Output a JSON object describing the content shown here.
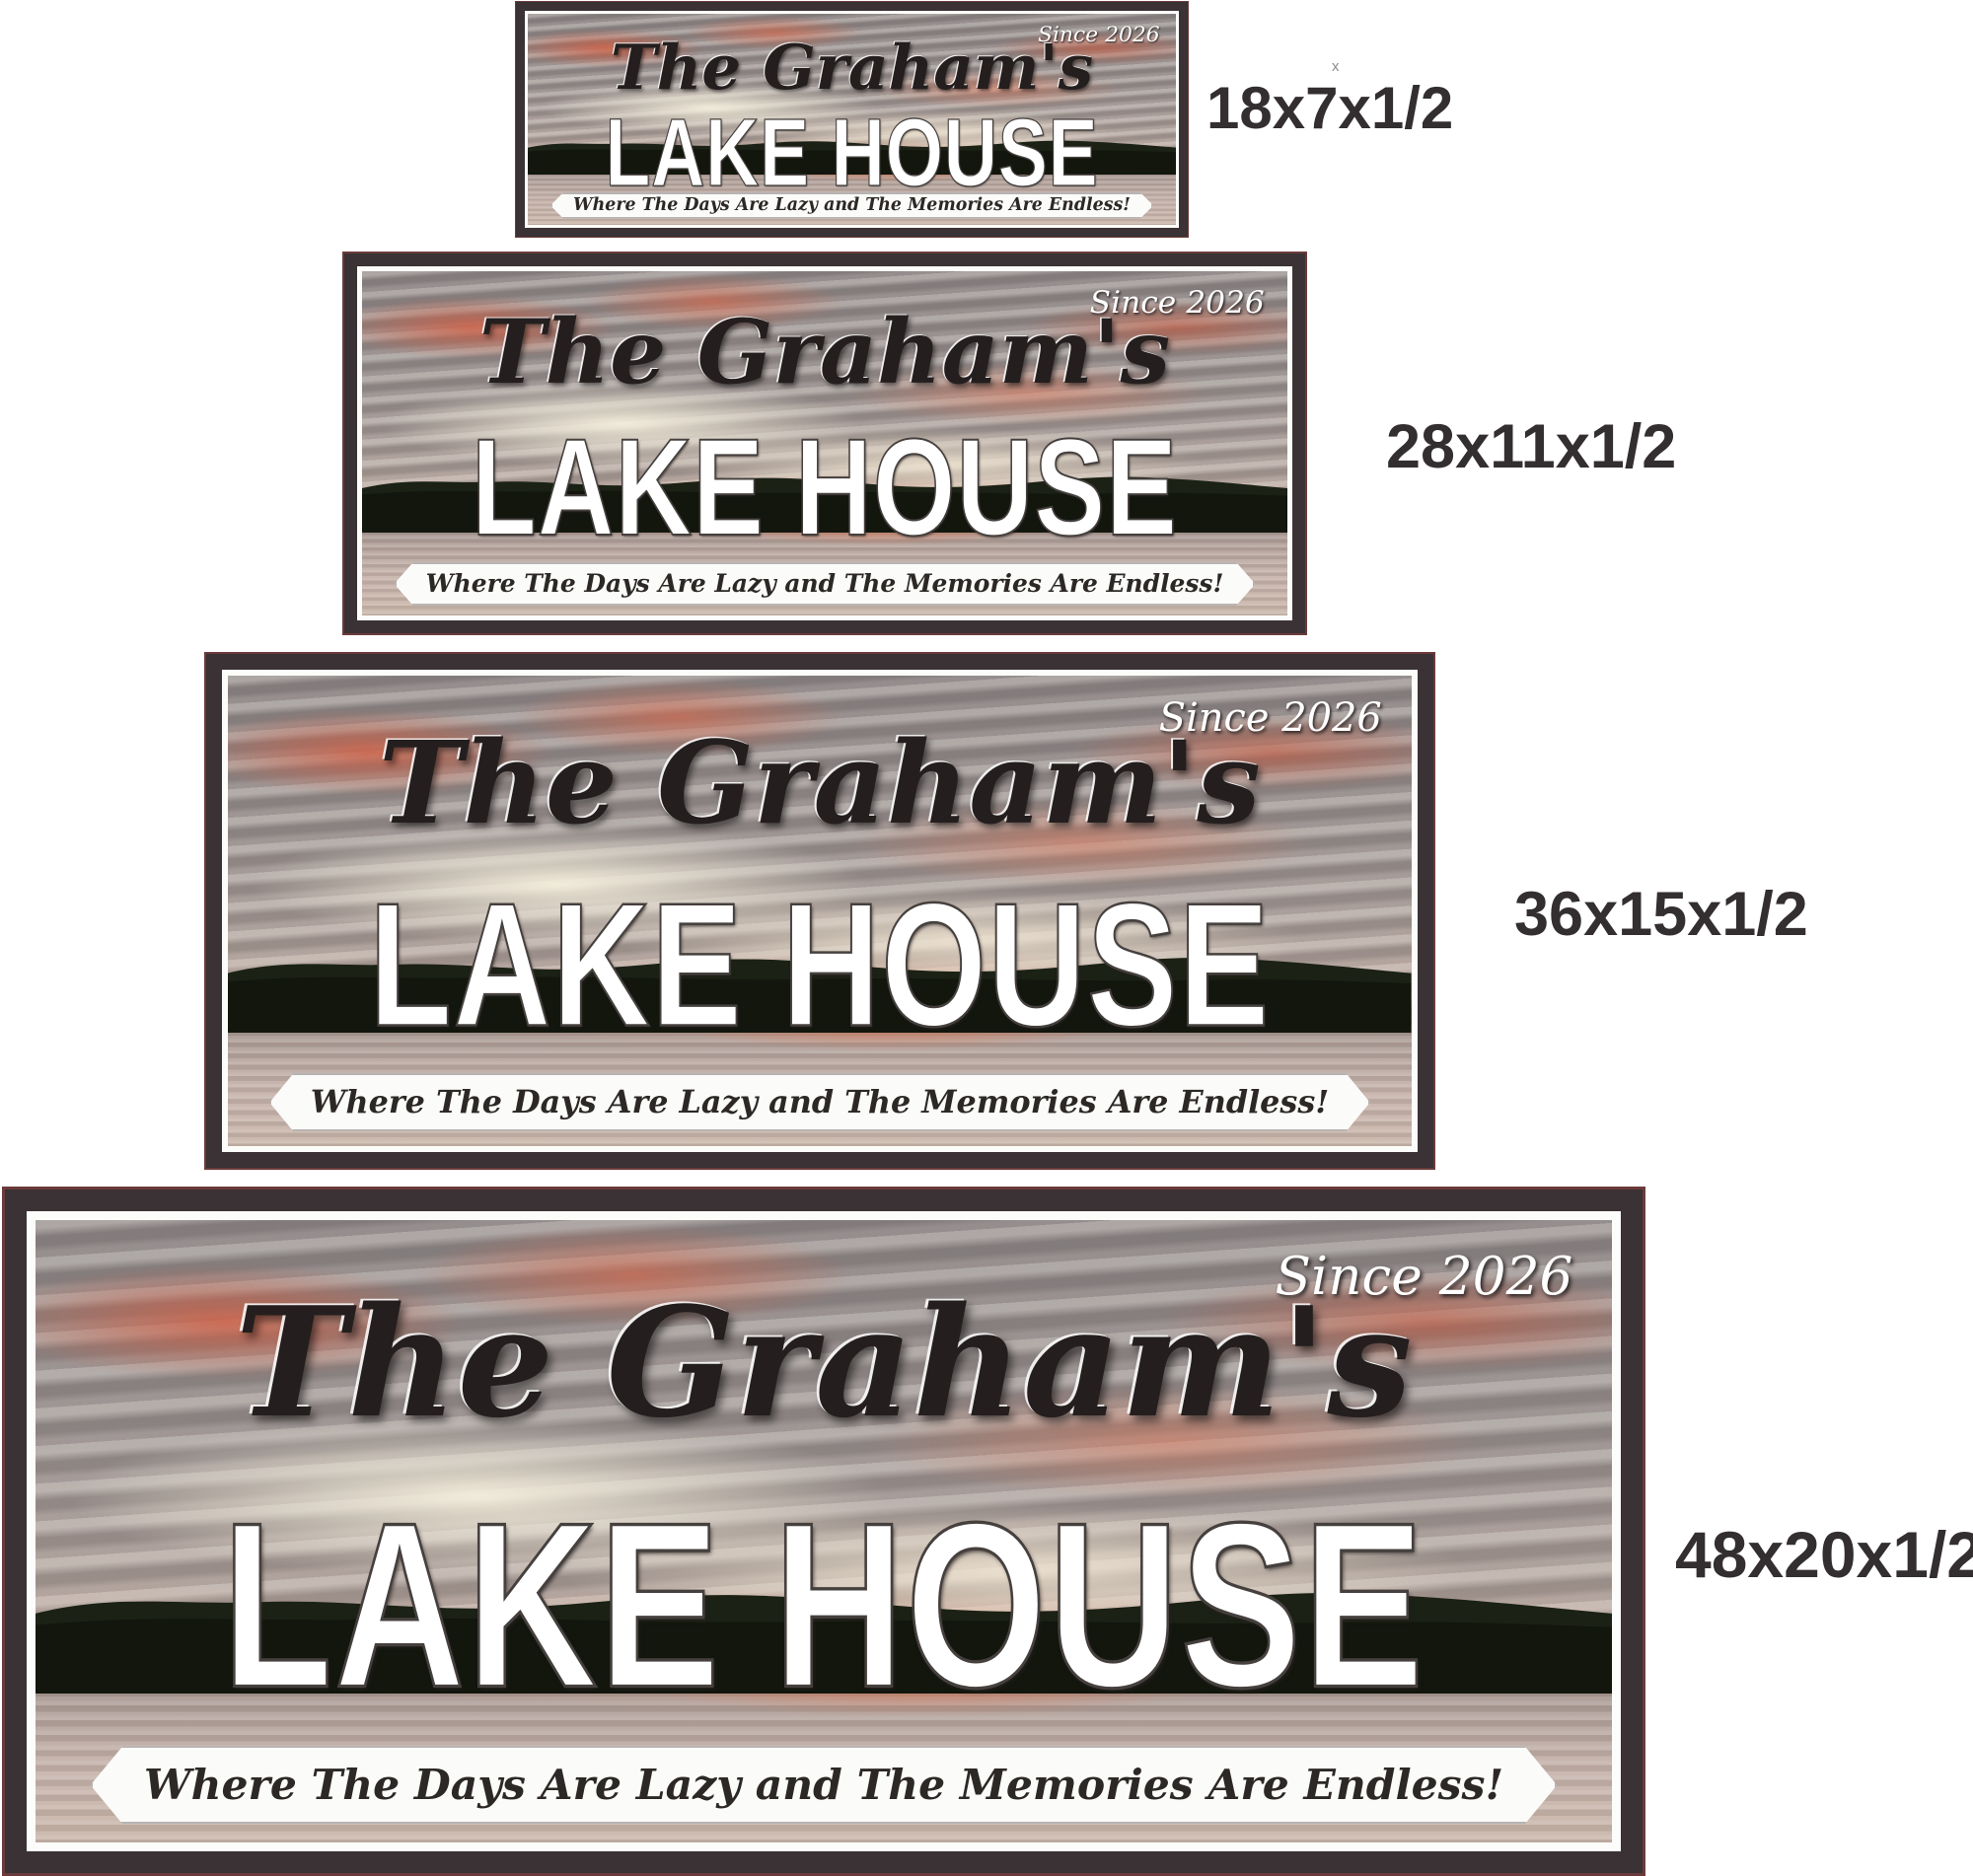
{
  "page": {
    "background_color": "#ffffff",
    "description_texts": {}
  },
  "sign_shared_text": {
    "family_name": "The Graham's",
    "title": "LAKE HOUSE",
    "since": "Since 2026",
    "tagline": "Where The Days Are Lazy and The Memories Are Endless!"
  },
  "signs": [
    {
      "size_label": "18x7x1/2"
    },
    {
      "size_label": "28x11x1/2"
    },
    {
      "size_label": "36x15x1/2"
    },
    {
      "size_label": "48x20x1/2"
    }
  ],
  "annotations": {
    "stray_mark": "x"
  },
  "colors": {
    "frame_dark": "#3a3234",
    "frame_outer_line": "#6b3a3a",
    "inner_border": "#fcfcfa",
    "title_text": "#ffffff",
    "title_outline": "#45403e",
    "family_text": "#241f1e",
    "since_text": "#ffffff",
    "tagline_text": "#2c2826",
    "banner_background": "#fbfbf9",
    "size_label_text": "#332e2f",
    "sky_gray": "#8b8485",
    "sunset_orange": "#d55c40",
    "cloud_cream": "#f7f1df",
    "hills_dark": "#1b2115",
    "water_pink": "#c6b3ab"
  }
}
